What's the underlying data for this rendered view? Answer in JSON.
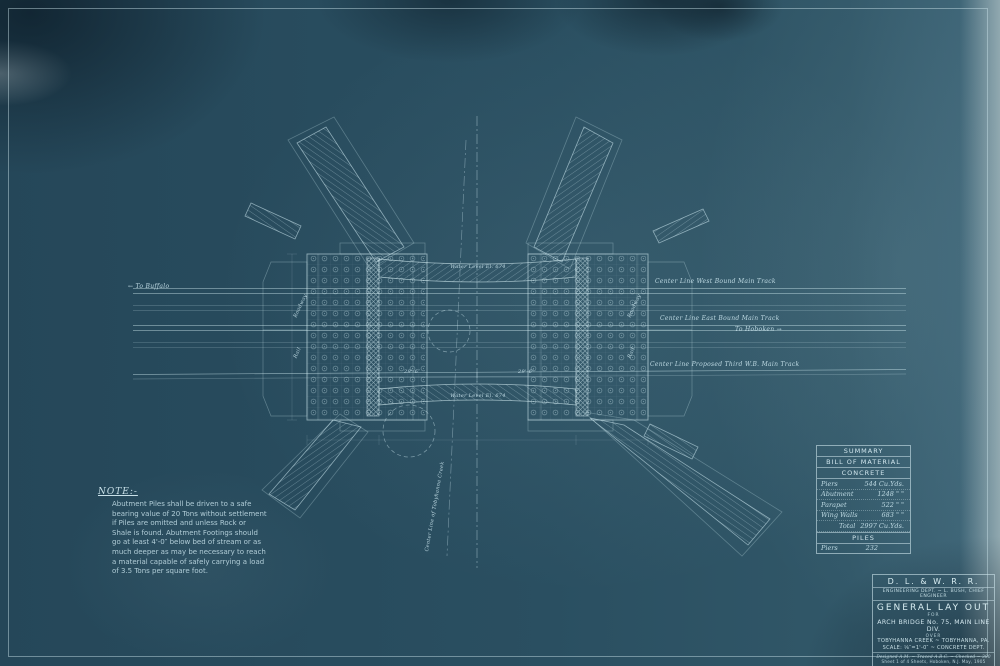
{
  "accent_colors": {
    "paper_blue": "#2a4f61",
    "ink_light": "#cfe7ee"
  },
  "tracks": {
    "to_buffalo": "← To Buffalo",
    "west": "Center Line West Bound Main Track",
    "east": "Center Line East Bound Main Track",
    "to_hoboken": "To Hoboken →",
    "third": "Center Line Proposed Third W.B. Main Track"
  },
  "drawing_labels": {
    "creek": "Center Line of Tobyhanna Creek",
    "roadway": "Roadway",
    "rail": "Rail",
    "water_top": "Water Level El. 674",
    "water_bottom": "Water Level El. 674",
    "dim_left": "29'-6″",
    "dim_right": "29'-6″"
  },
  "note": {
    "heading": "NOTE:-",
    "lines": [
      "Abutment Piles shall be driven to a safe",
      "bearing value of 20 Tons without settlement",
      "if Piles are omitted and unless Rock or",
      "Shale is found. Abutment Footings should",
      "go at least 4'-0″ below bed of stream or as",
      "much deeper as may be necessary to reach",
      "a material capable of safely carrying a load",
      "of 3.5 Tons per square foot."
    ]
  },
  "summary": {
    "title1": "SUMMARY",
    "title2": "BILL OF MATERIAL",
    "section1": "CONCRETE",
    "rows": [
      {
        "label": "Piers",
        "value": "544 Cu.Yds."
      },
      {
        "label": "Abutment",
        "value": "1248  \"  \""
      },
      {
        "label": "Parapet",
        "value": "522  \"  \""
      },
      {
        "label": "Wing Walls",
        "value": "683  \"  \""
      },
      {
        "label": "Total",
        "value": "2997 Cu.Yds."
      }
    ],
    "section2": "PILES",
    "piles_row": {
      "label": "Piers",
      "value": "232"
    }
  },
  "title_block": {
    "railroad": "D. L. & W. R. R.",
    "dept": "ENGINEERING DEPT. ~ L. BUSH, CHIEF ENGINEER",
    "title": "GENERAL LAY OUT",
    "for_word": "FOR",
    "subject": "ARCH BRIDGE No. 75, MAIN LINE DIV.",
    "over_word": "OVER",
    "location": "TOBYHANNA CREEK ~ TOBYHANNA, PA.",
    "scale": "SCALE: ⅛″=1'-0″  ~  CONCRETE DEPT.",
    "credits": "Designed A.M. ~ Traced A.B.C. ~ Checked ~ 380",
    "sheet_info": "Sheet 1 of 4 Sheets, Hoboken, N.J. May, 1905"
  }
}
